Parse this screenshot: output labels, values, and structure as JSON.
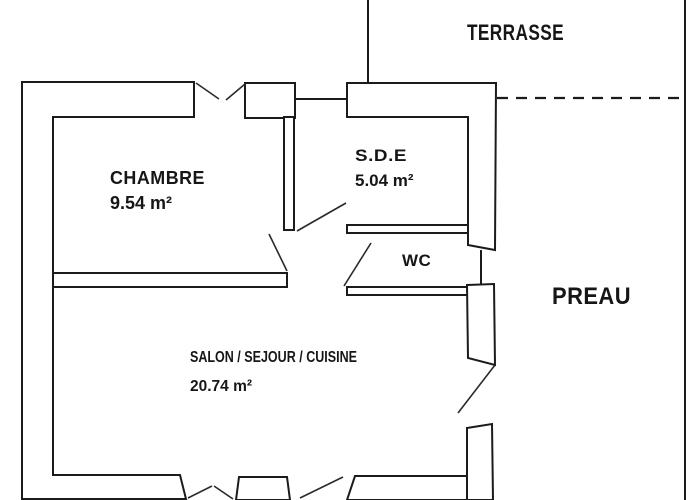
{
  "plan": {
    "colors": {
      "line": "#1b1b1b",
      "background": "#ffffff"
    },
    "rooms": {
      "terrasse": {
        "label": "TERRASSE"
      },
      "chambre": {
        "label": "CHAMBRE",
        "area": "9.54 m²"
      },
      "sde": {
        "label": "S.D.E",
        "area": "5.04 m²"
      },
      "wc": {
        "label": "WC"
      },
      "salon": {
        "label": "SALON / SEJOUR / CUISINE",
        "area": "20.74 m²"
      },
      "preau": {
        "label": "PREAU"
      }
    }
  }
}
